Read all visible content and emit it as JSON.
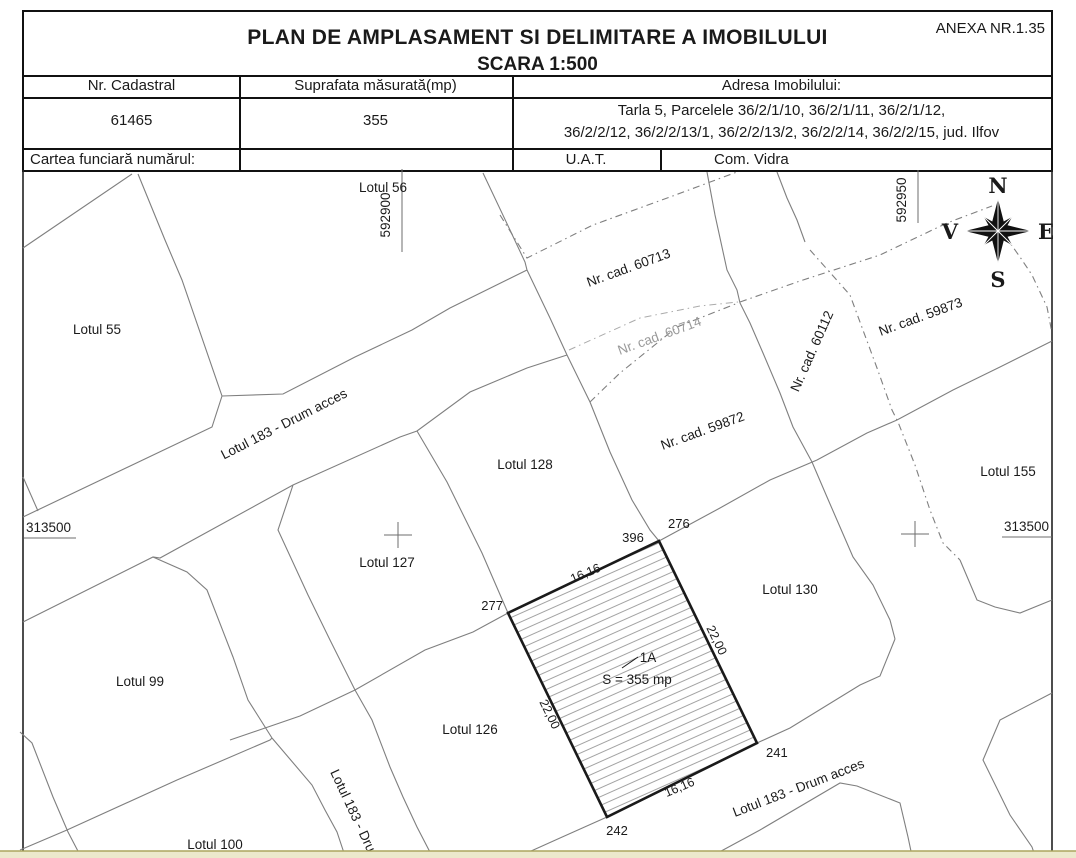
{
  "header": {
    "annex": "ANEXA NR.1.35",
    "title_line1": "PLAN DE AMPLASAMENT SI DELIMITARE A IMOBILULUI",
    "title_line2": "SCARA 1:500",
    "col_cadastral": "Nr. Cadastral",
    "col_suprafata": "Suprafata măsurată(mp)",
    "col_adresa": "Adresa Imobilului:",
    "val_cadastral": "61465",
    "val_suprafata": "355",
    "val_adresa_line1": "Tarla 5, Parcelele 36/2/1/10, 36/2/1/11, 36/2/1/12,",
    "val_adresa_line2": "36/2/2/12, 36/2/2/13/1, 36/2/2/13/2, 36/2/2/14, 36/2/2/15, jud. Ilfov",
    "cartea_label": "Cartea funciară numărul:",
    "uat_label": "U.A.T.",
    "uat_value": "Com. Vidra"
  },
  "map": {
    "grid": {
      "easting_left": "592900",
      "easting_right": "592950",
      "northing": "313500"
    },
    "compass": {
      "n": "N",
      "e": "E",
      "s": "S",
      "v": "V"
    },
    "lots": {
      "l55": "Lotul 55",
      "l56": "Lotul 56",
      "l99": "Lotul 99",
      "l100": "Lotul 100",
      "l126": "Lotul 126",
      "l127": "Lotul 127",
      "l128": "Lotul 128",
      "l130": "Lotul 130",
      "l155": "Lotul 155",
      "road": "Lotul 183 - Drum acces"
    },
    "cad": {
      "c60713": "Nr. cad. 60713",
      "c60714": "Nr. cad. 60714",
      "c59872": "Nr. cad. 59872",
      "c59873": "Nr. cad. 59873",
      "c60112": "Nr. cad. 60112"
    },
    "parcel": {
      "id": "1A",
      "area": "S = 355 mp",
      "p396": "396",
      "p276": "276",
      "p277": "277",
      "p241": "241",
      "p242": "242",
      "len_short": "16,16",
      "len_long": "22,00"
    }
  },
  "colors": {
    "line_gray": "#7f7f7f",
    "hatch_gray": "#999999",
    "outline_black": "#1a1a1a",
    "bottom_strip": "#ece9cc",
    "bottom_strip_edge": "#aba55e"
  }
}
